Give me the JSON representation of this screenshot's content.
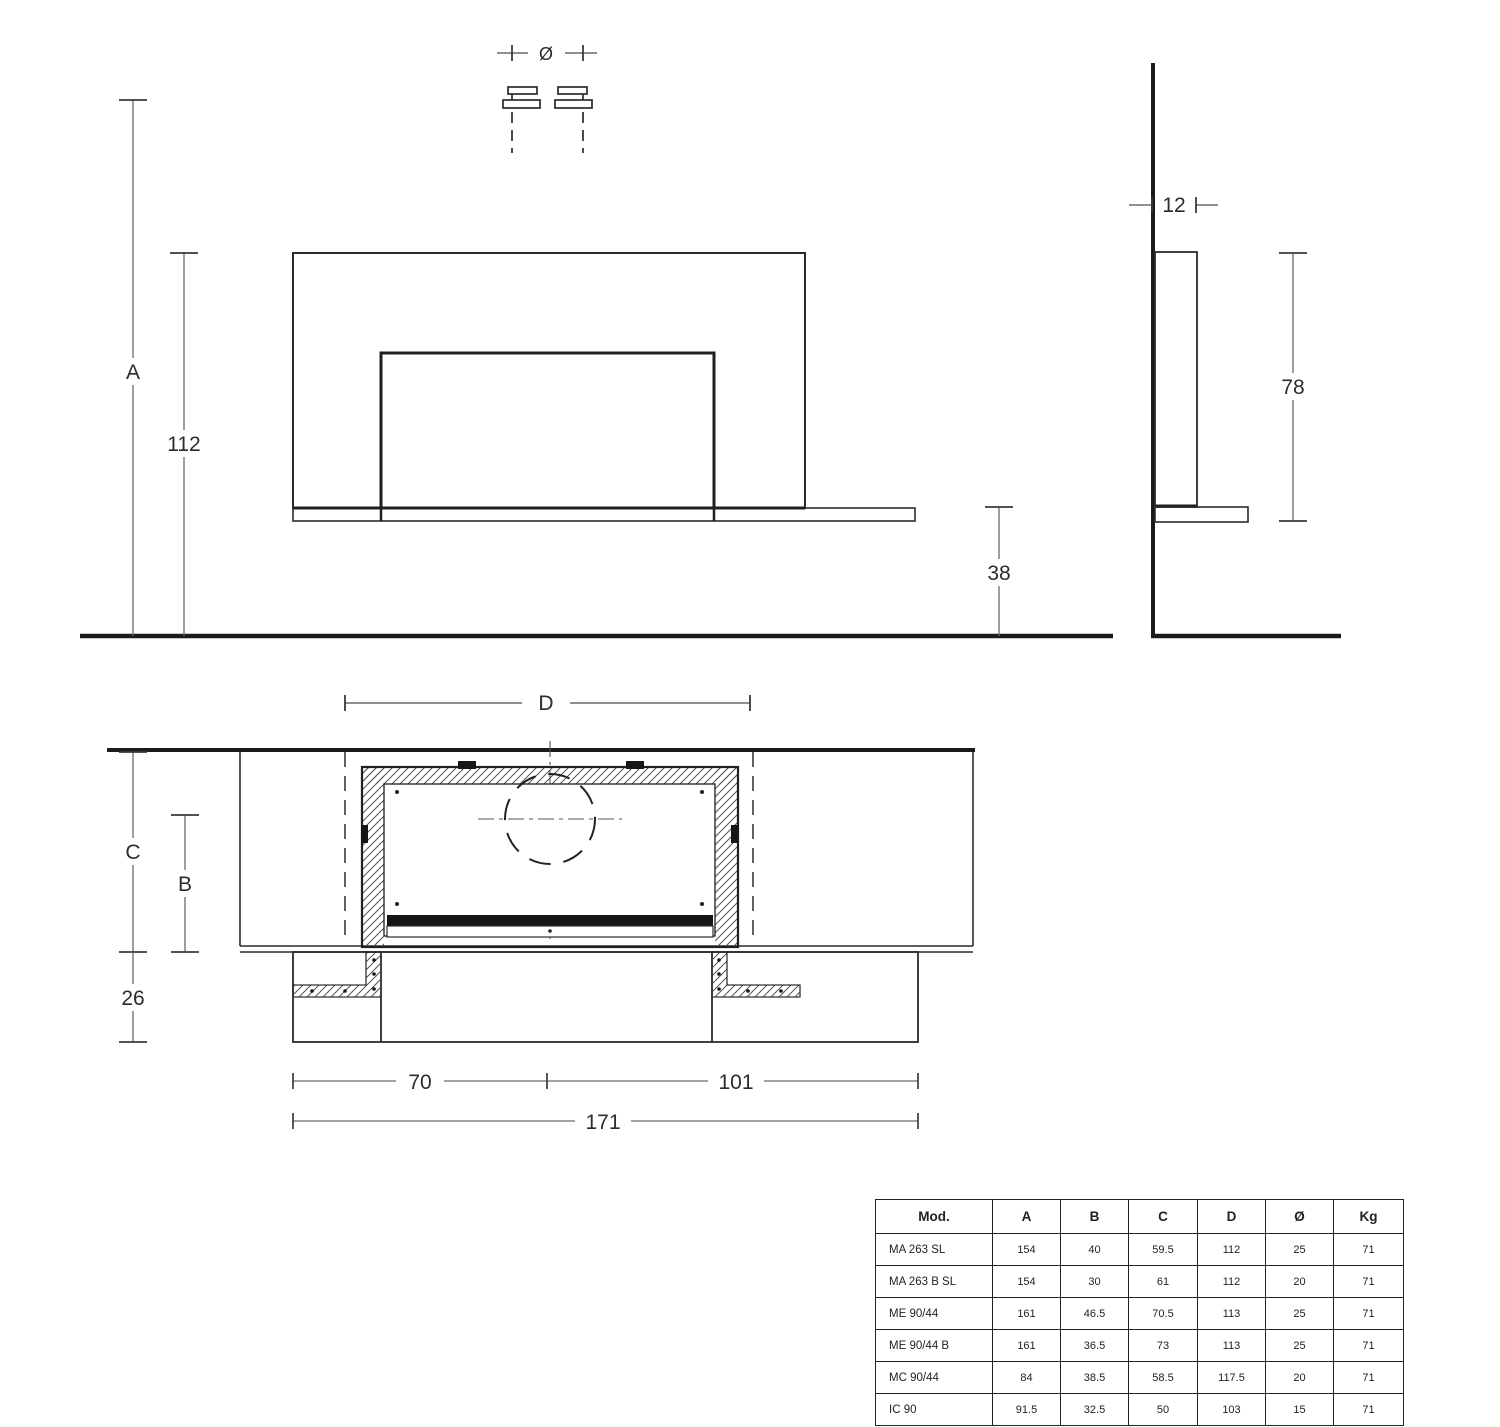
{
  "drawing": {
    "front_view": {
      "dim_diameter": "Ø",
      "dim_total_height": "A",
      "dim_panel_height": "112"
    },
    "side_view": {
      "dim_depth": "12",
      "dim_body_height": "78",
      "dim_bench_height": "38"
    },
    "plan_view": {
      "dim_panel_width": "D",
      "dim_total_depth": "C",
      "dim_body_depth": "B",
      "dim_front_depth": "26",
      "dim_left_width": "70",
      "dim_right_width": "101",
      "dim_total_width": "171"
    }
  },
  "table": {
    "headers": [
      "Mod.",
      "A",
      "B",
      "C",
      "D",
      "Ø",
      "Kg"
    ],
    "rows": [
      {
        "model": "MA 263 SL",
        "a": "154",
        "b": "40",
        "c": "59.5",
        "d": "112",
        "dia": "25",
        "kg": "71"
      },
      {
        "model": "MA 263 B SL",
        "a": "154",
        "b": "30",
        "c": "61",
        "d": "112",
        "dia": "20",
        "kg": "71"
      },
      {
        "model": "ME 90/44",
        "a": "161",
        "b": "46.5",
        "c": "70.5",
        "d": "113",
        "dia": "25",
        "kg": "71"
      },
      {
        "model": "ME 90/44 B",
        "a": "161",
        "b": "36.5",
        "c": "73",
        "d": "113",
        "dia": "25",
        "kg": "71"
      },
      {
        "model": "MC 90/44",
        "a": "84",
        "b": "38.5",
        "c": "58.5",
        "d": "117.5",
        "dia": "20",
        "kg": "71"
      },
      {
        "model": "IC 90",
        "a": "91.5",
        "b": "32.5",
        "c": "50",
        "d": "103",
        "dia": "15",
        "kg": "71"
      }
    ]
  }
}
